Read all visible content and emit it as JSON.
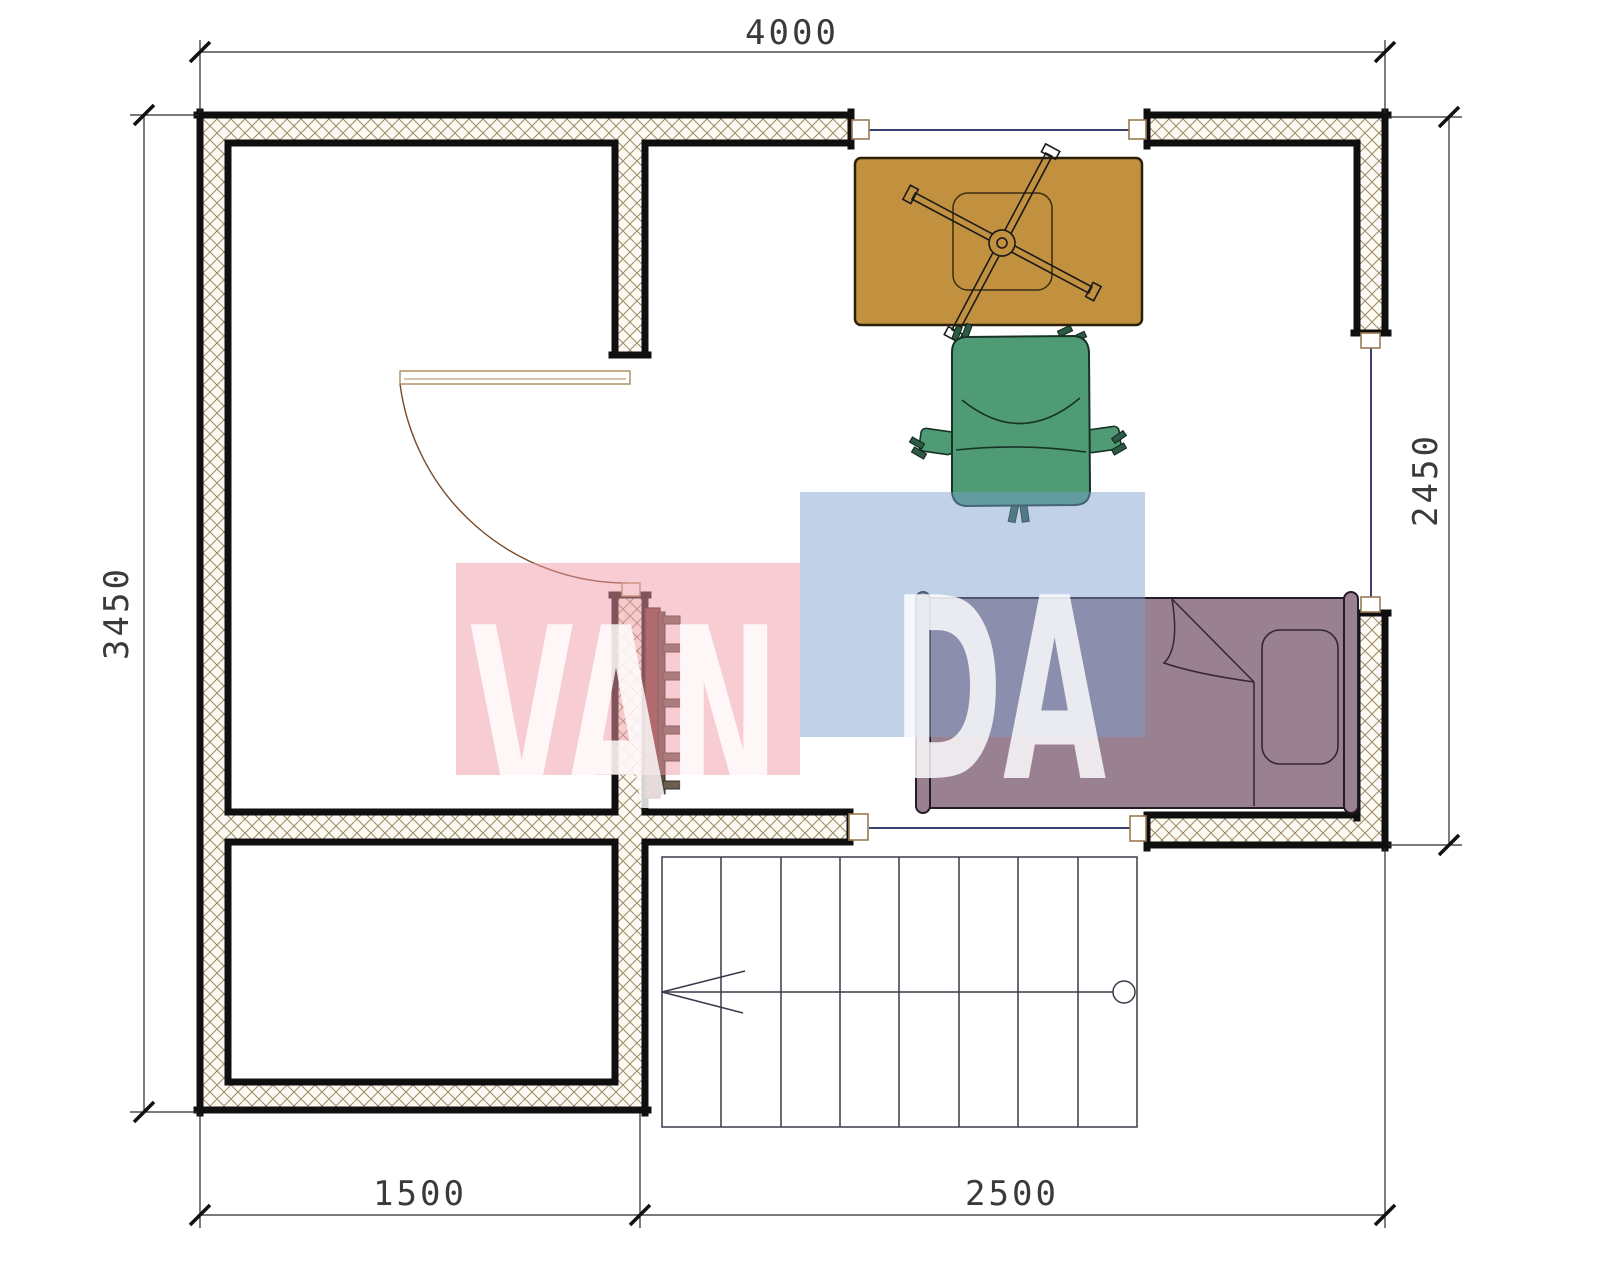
{
  "drawing": {
    "type": "architectural-floor-plan",
    "dimensions": {
      "top": "4000",
      "left": "3450",
      "right": "2450",
      "bottom_left": "1500",
      "bottom_right": "2500"
    },
    "watermark": {
      "text": "VANDA",
      "part1": "VAN",
      "part2": "DA",
      "pink_block_color": "#F099A8",
      "blue_block_color": "#7B9DCD",
      "letter_color": "rgba(255,255,255,0.82)"
    },
    "elements": {
      "walls": "hatched-masonry",
      "windows_count": 3,
      "door": "quarter-circle-swing",
      "staircase_treads": 8,
      "furniture": [
        {
          "name": "desk",
          "color": "#C2913F"
        },
        {
          "name": "office-chair",
          "color": "#4F9B76"
        },
        {
          "name": "bed",
          "color": "#9A8191"
        },
        {
          "name": "radiator",
          "color": "#733B33"
        }
      ]
    },
    "colors": {
      "wall_line": "#0F0F0F",
      "hatch_line": "#9B8A67",
      "window_glass_line": "#3A4070",
      "door_arc": "#7A4A28",
      "dimension_line": "#2A2A2A"
    }
  }
}
